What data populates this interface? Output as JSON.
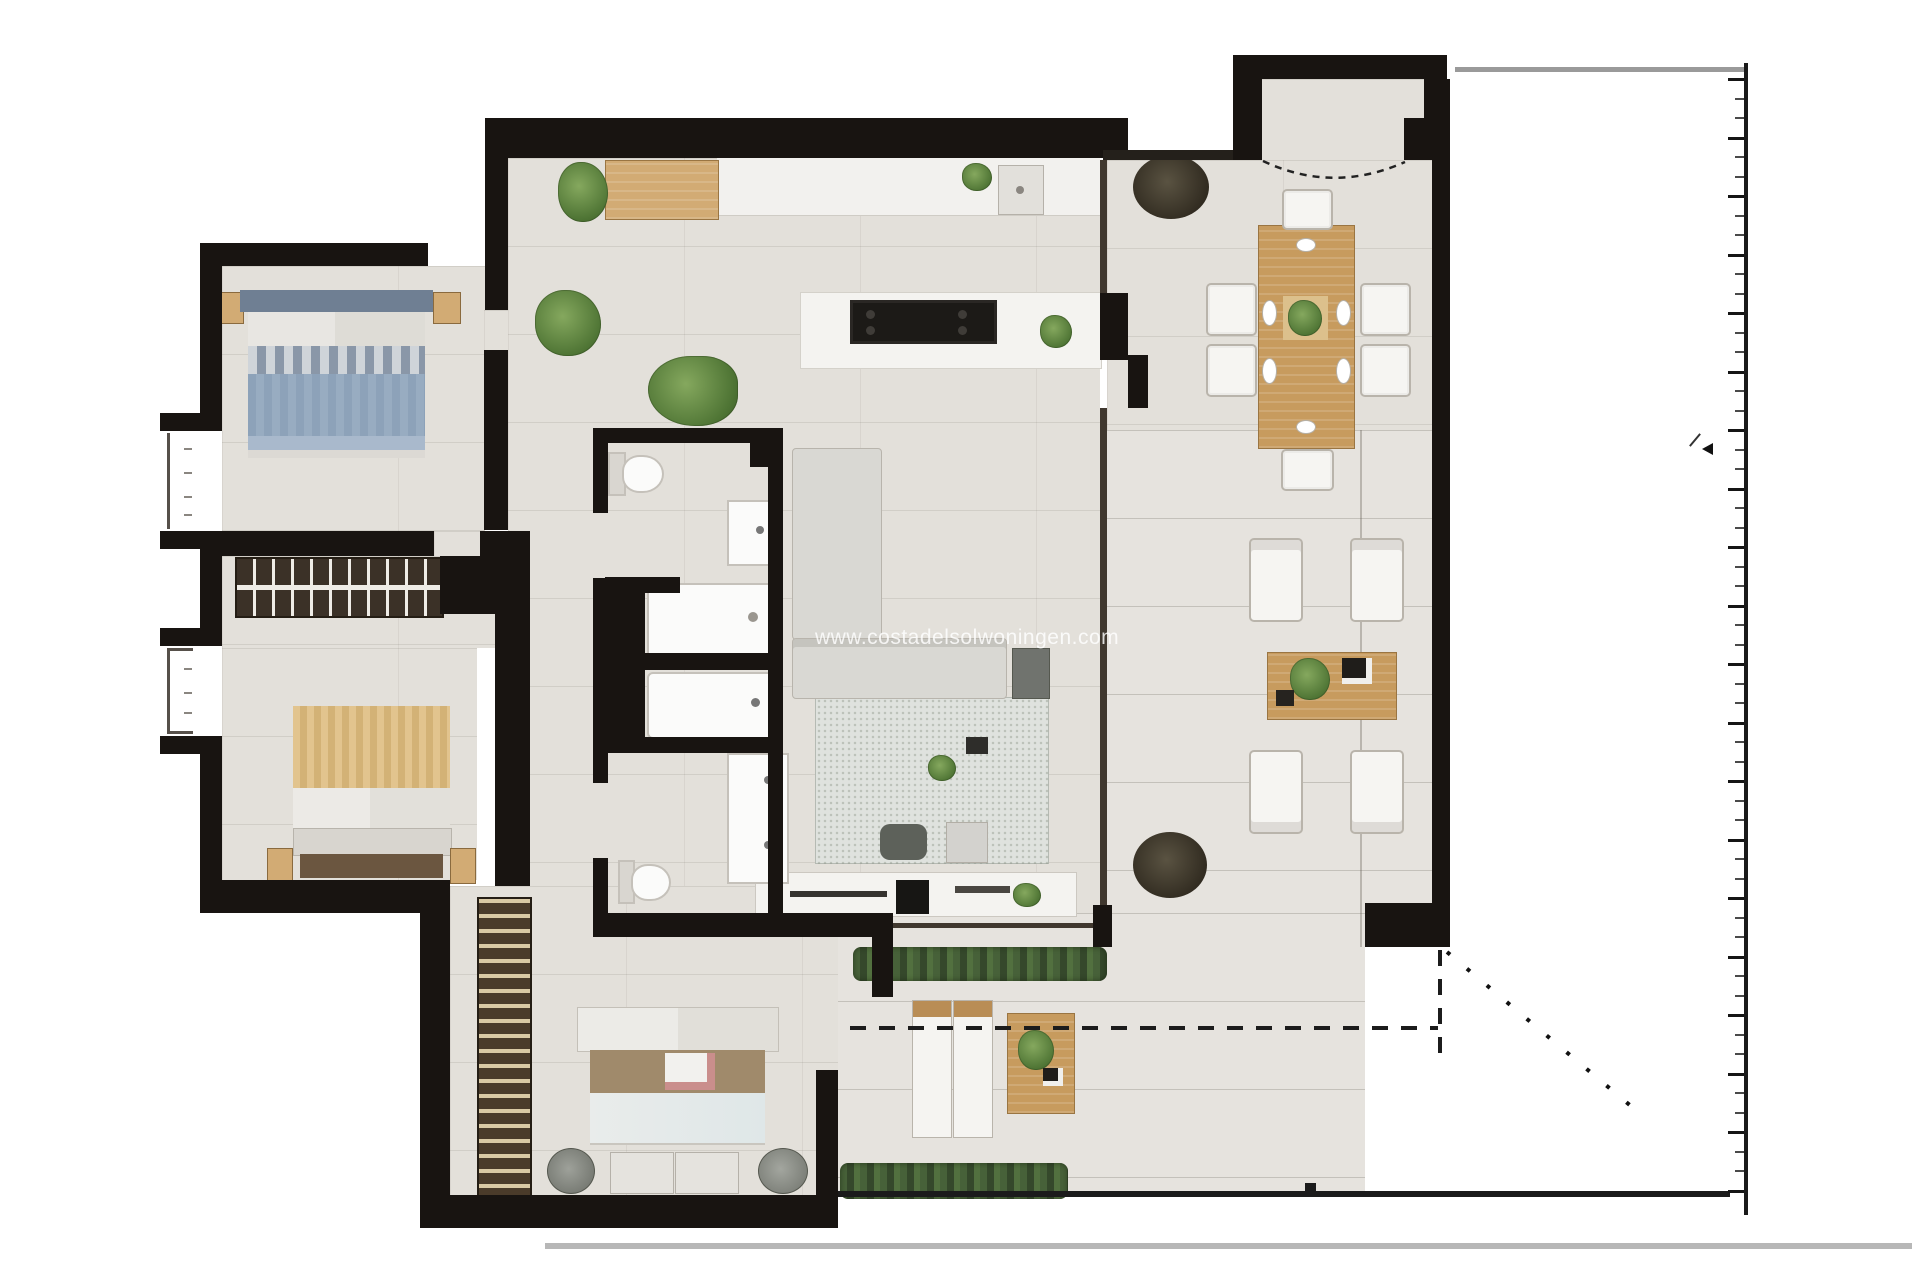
{
  "watermark": {
    "text": "www.costadelsolwoningen.com"
  },
  "colors": {
    "wall": "#181411",
    "floor": "#e3e0da",
    "floor_terrace": "#e6e3de",
    "wood": "#c79b5e",
    "wood_light": "#d2ab74",
    "wood_dark": "#6b5640",
    "bed_blue": "#8fa3ba",
    "bed_blue_head": "#6f7f93",
    "bed_tan": "#dfc08a",
    "blanket_brown": "#a08a6b",
    "plant": "#5e8140",
    "plant_dark": "#3a3328",
    "hedge": "#3f5a33",
    "fabric": "#f6f5f2",
    "sofa": "#d9d8d3",
    "rug": "#dfe2de",
    "line_gray": "#9a9a9a"
  },
  "plan": {
    "type": "apartment-floor-plan-top-view",
    "rooms": [
      {
        "name": "bedroom-top-left",
        "furniture": [
          "double-bed-blue",
          "nightstand",
          "nightstand"
        ]
      },
      {
        "name": "bedroom-mid-left",
        "furniture": [
          "double-bed-tan",
          "nightstand",
          "nightstand",
          "foot-bench"
        ]
      },
      {
        "name": "master-bedroom",
        "furniture": [
          "double-bed-brown-blanket",
          "round-chair",
          "round-chair",
          "bench",
          "bench",
          "striped-wardrobe"
        ]
      },
      {
        "name": "hallway",
        "furniture": [
          "cross-hatch-wardrobe"
        ]
      },
      {
        "name": "bathroom-top",
        "furniture": [
          "toilet",
          "washbasin",
          "shower-tray",
          "bathtub"
        ]
      },
      {
        "name": "bathroom-bottom",
        "furniture": [
          "double-vanity",
          "toilet"
        ]
      },
      {
        "name": "kitchen",
        "furniture": [
          "counter",
          "sink",
          "sideboard",
          "island-with-cooktop",
          "plants"
        ]
      },
      {
        "name": "living-room",
        "furniture": [
          "l-shaped-sofa",
          "armchair-dark",
          "rug",
          "pouf",
          "ottoman",
          "tv-console",
          "soundbar"
        ]
      },
      {
        "name": "dining-area",
        "furniture": [
          "wood-table",
          "chair",
          "chair",
          "chair",
          "chair",
          "chair",
          "chair",
          "plant-pot-large"
        ]
      },
      {
        "name": "entry-vestibule",
        "furniture": [
          "door-swing-arc"
        ]
      },
      {
        "name": "terrace",
        "furniture": [
          "armchair",
          "armchair",
          "armchair",
          "armchair",
          "coffee-table",
          "sun-lounger",
          "sun-lounger",
          "side-table",
          "hedge",
          "hedge",
          "plant-pot-large"
        ]
      }
    ]
  },
  "ruler": {
    "side": "right",
    "start_y": 78,
    "tick_spacing": 19.5,
    "tick_count": 58,
    "long_every": 3
  }
}
